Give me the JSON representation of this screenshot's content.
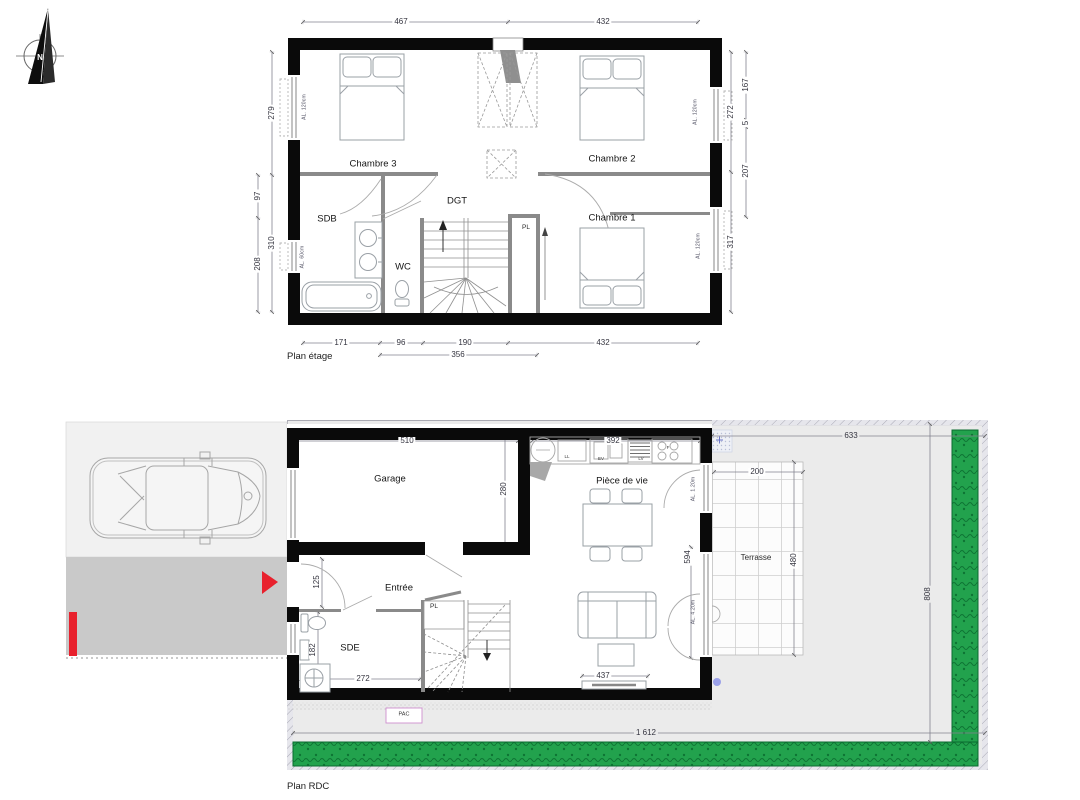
{
  "compass": {
    "north_letter": "N"
  },
  "etage": {
    "title": "Plan étage",
    "rooms": {
      "chambre3": "Chambre 3",
      "chambre2": "Chambre 2",
      "chambre1": "Chambre 1",
      "dgt": "DGT",
      "sdb": "SDB",
      "wc": "WC",
      "placard": "PL"
    },
    "dims": {
      "top_left": "467",
      "top_right": "432",
      "left_a": "279",
      "left_b": "310",
      "left_inner_a": "97",
      "left_inner_b": "208",
      "right_a": "272",
      "right_b": "317",
      "right_outer_a": "167",
      "right_outer_b": "5",
      "right_outer_c": "207",
      "bottom_a": "171",
      "bottom_b": "96",
      "bottom_c": "190",
      "bottom_d": "432",
      "bottom_total": "356"
    },
    "windows": {
      "c3": "AL. 120cm",
      "c2": "AL. 120cm",
      "c1": "AL. 120cm",
      "sdb": "AL. 60cm"
    }
  },
  "rdc": {
    "title": "Plan RDC",
    "rooms": {
      "garage": "Garage",
      "piece_de_vie": "Pièce de vie",
      "entree": "Entrée",
      "sde": "SDE",
      "terrasse": "Terrasse",
      "placard": "PL",
      "pac": "PAC"
    },
    "kitchen": {
      "ll": "LL",
      "ev": "EV",
      "lv": "LV",
      "four": "F"
    },
    "dims": {
      "garage_w": "510",
      "garage_h": "280",
      "kitchen_w": "392",
      "entree_door": "125",
      "sde_h": "182",
      "sde_w": "272",
      "radiator": "437",
      "bay": "594",
      "terrasse_w": "200",
      "terrasse_h": "480",
      "garden_w": "633",
      "garden_h": "808",
      "total_w": "1 612"
    },
    "windows": {
      "salon_top": "AL. 1.20m",
      "salon_bay": "AL. 4.20m"
    }
  },
  "colors": {
    "hedge_green": "#22a24d",
    "alert_red": "#e8212d",
    "wall_black": "#0a0a0a"
  }
}
